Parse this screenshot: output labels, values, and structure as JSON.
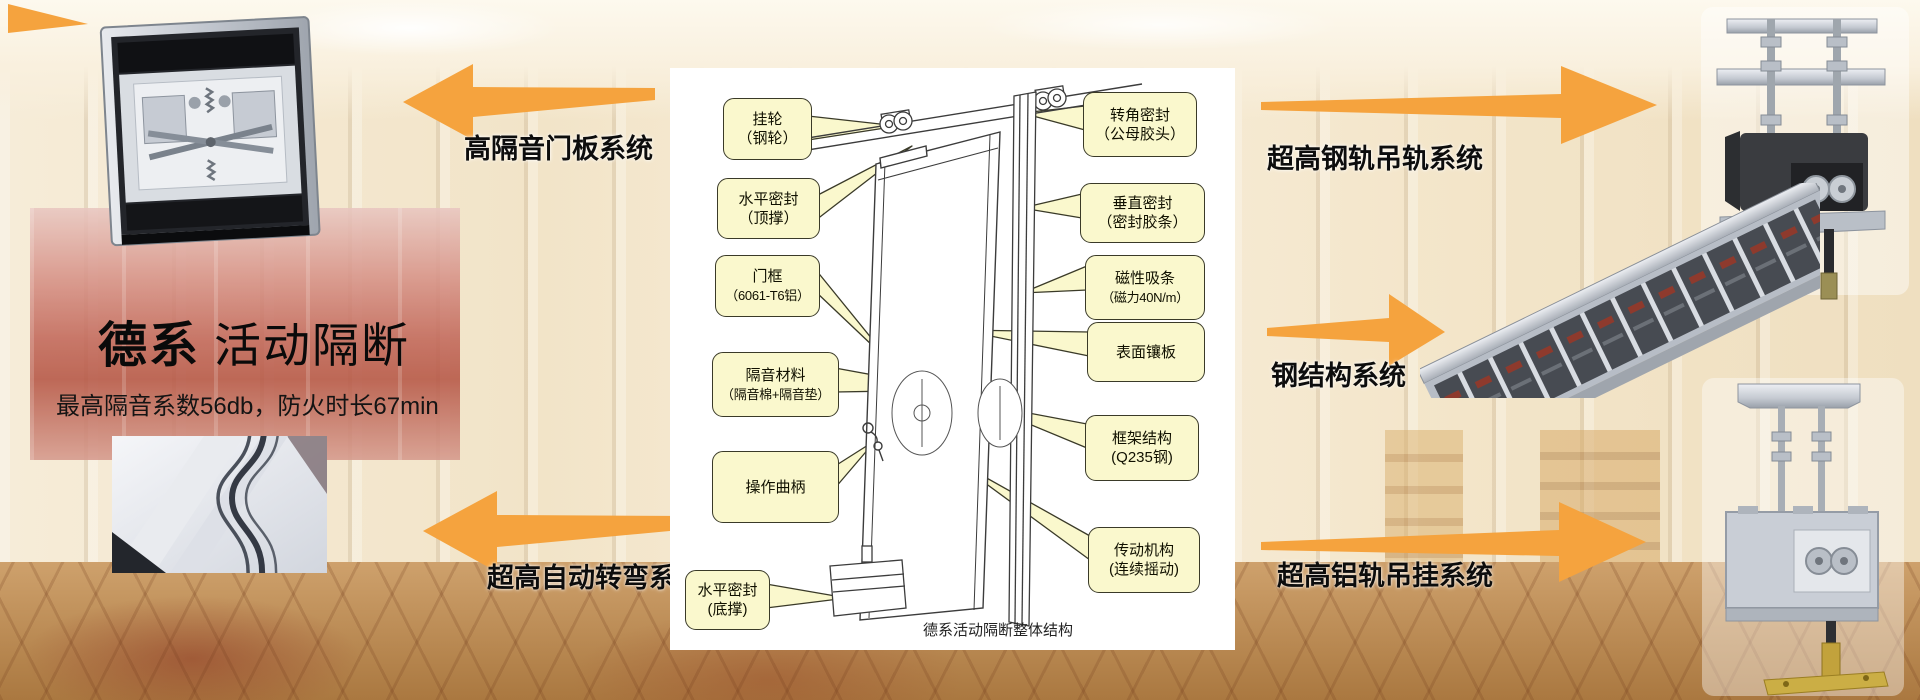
{
  "slide": {
    "title_primary": "德系",
    "title_secondary": "活动隔断",
    "subtitle": "最高隔音系数56db，防火时长67min"
  },
  "colors": {
    "arrow_orange": "#F5A33E",
    "callout_fill": "#FAF8CD",
    "callout_border": "#3A3A28",
    "panel_background": "#FFFFFF"
  },
  "arrows_left": [
    {
      "label": "高隔音门板系统"
    },
    {
      "label": "超高自动转弯系统"
    }
  ],
  "arrows_right": [
    {
      "label": "超高钢轨吊轨系统"
    },
    {
      "label": "钢结构系统"
    },
    {
      "label": "超高铝轨吊挂系统"
    }
  ],
  "diagram": {
    "caption": "德系活动隔断整体结构",
    "left_callouts": [
      {
        "line1": "挂轮",
        "line2": "（钢轮）"
      },
      {
        "line1": "水平密封",
        "line2": "（顶撑）"
      },
      {
        "line1": "门框",
        "line2": "（6061-T6铝）"
      },
      {
        "line1": "隔音材料",
        "line2": "（隔音棉+隔音垫）"
      },
      {
        "line1": "操作曲柄",
        "line2": ""
      },
      {
        "line1": "水平密封",
        "line2": "(底撑)"
      }
    ],
    "right_callouts": [
      {
        "line1": "转角密封",
        "line2": "（公母胶头）"
      },
      {
        "line1": "垂直密封",
        "line2": "（密封胶条）"
      },
      {
        "line1": "磁性吸条",
        "line2": "（磁力40N/m）"
      },
      {
        "line1": "表面镶板",
        "line2": ""
      },
      {
        "line1": "框架结构",
        "line2": "(Q235钢)"
      },
      {
        "line1": "传动机构",
        "line2": "(连续摇动)"
      }
    ]
  },
  "photos": {
    "top_left": "door-panel-top-mechanism",
    "bottom_left": "curved-track-closeup",
    "top_right": "steel-track-hanging-carrier",
    "middle_right": "steel-structure-frame",
    "bottom_right": "aluminum-track-hanging-carrier"
  }
}
